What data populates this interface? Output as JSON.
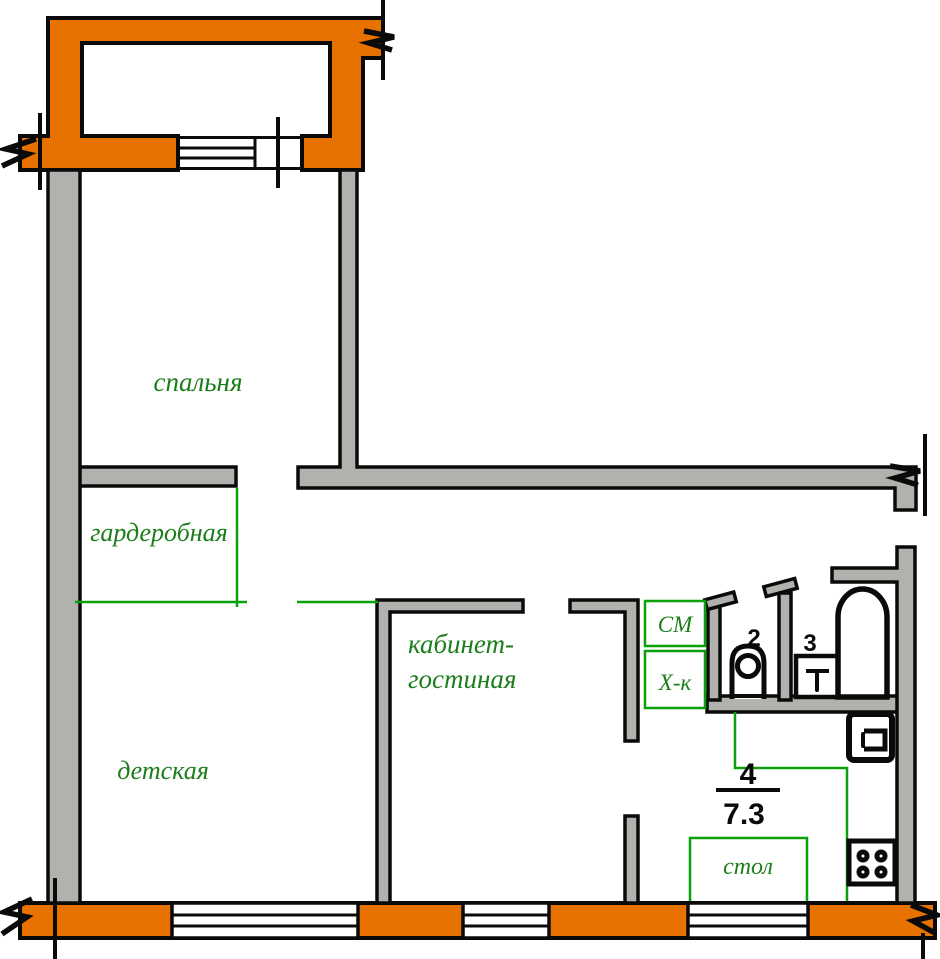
{
  "plan": {
    "rooms": {
      "bedroom": "спальня",
      "wardrobe": "гардеробная",
      "nursery": "детская",
      "study_line1": "кабинет-",
      "study_line2": "гостиная"
    },
    "kitchen": {
      "number": "4",
      "area": "7.3",
      "table": "стол"
    },
    "appliances": {
      "washer": "СМ",
      "fridge": "Х-к"
    },
    "bath": {
      "wc_number": "2",
      "bath_number": "3"
    },
    "colors": {
      "c_ext": "#E87200",
      "c_int": "#B1B1AE",
      "c_green_line": "#0AA00A",
      "c_green_text": "#1B7E1B"
    }
  }
}
